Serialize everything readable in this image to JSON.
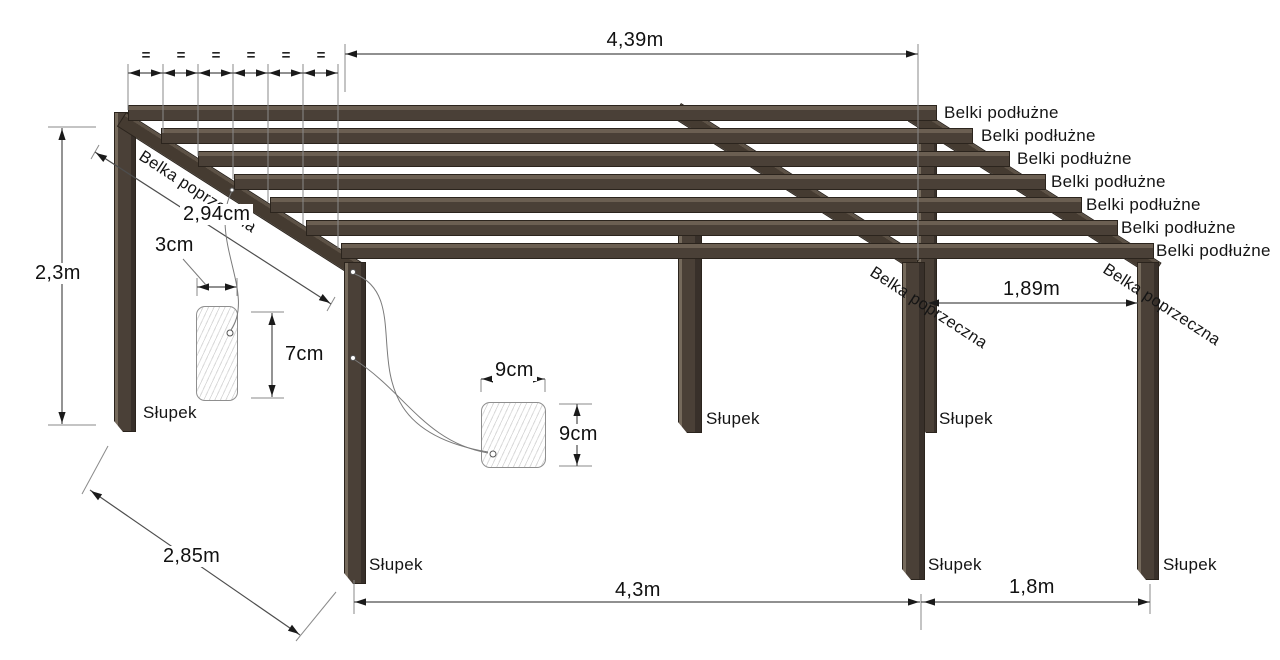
{
  "drawing": {
    "type": "pergola construction diagram",
    "labels": {
      "beam_long": "Belki podłużne",
      "beam_cross": "Belka poprzeczna",
      "post": "Słupek",
      "equal": "="
    },
    "dimensions": {
      "top_span": "4,39m",
      "height": "2,3m",
      "depth": "2,85m",
      "bay_main": "4,3m",
      "bay_side": "1,8m",
      "bay_right": "1,89m",
      "cross_beam_length": "2,94cm",
      "rafter_section_width": "3cm",
      "rafter_section_height": "7cm",
      "post_section_width": "9cm",
      "post_section_height": "9cm"
    },
    "counts": {
      "longitudinal_beams": 7,
      "posts": 6,
      "cross_beams": 3
    },
    "colors": {
      "wood": "#4a4037",
      "wood_highlight": "#6b5f52",
      "wood_shadow": "#38302a",
      "outline": "#2b241d",
      "dimension_line": "#4d4d4d",
      "text": "#151515",
      "background": "#ffffff"
    }
  }
}
